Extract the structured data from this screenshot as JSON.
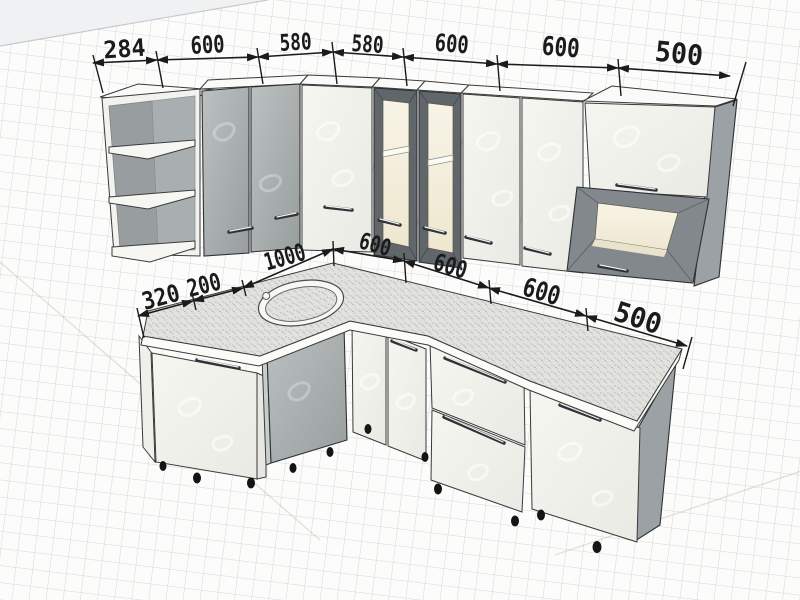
{
  "page": {
    "description": "Perspective 3D drawing of an L-shaped corner kitchen cabinet set with black dimension annotations, rendered on light graph paper"
  },
  "dimensions": {
    "wall_row": [
      "284",
      "600",
      "580",
      "580",
      "600",
      "600",
      "500"
    ],
    "base_row": [
      "320",
      "200",
      "1000",
      "600",
      "600",
      "600",
      "500"
    ]
  },
  "scene": {
    "wall_units": [
      "open corner shelf unit",
      "gray double-door cabinet",
      "white corner door cabinet",
      "glass door cabinet",
      "glass door cabinet",
      "white double-door cabinet",
      "flip-up door cabinet with open niche"
    ],
    "base_units": [
      "angled corner door cabinet",
      "corner sink cabinet with oval sink",
      "white double-door cabinet",
      "two-drawer cabinet",
      "end door cabinet"
    ]
  },
  "colors": {
    "dimension_ink": "#1b1b1b",
    "paper": "#fcfcfb",
    "grid_line": "#d4d7dc",
    "cabinet_white": "#f2f2ec",
    "cabinet_gray": "#a9aeae",
    "glass_frame_dark": "#60666a",
    "niche_interior_warm": "#f6f1df",
    "countertop_speckle": "#e2e3df",
    "feet_black": "#141414"
  }
}
